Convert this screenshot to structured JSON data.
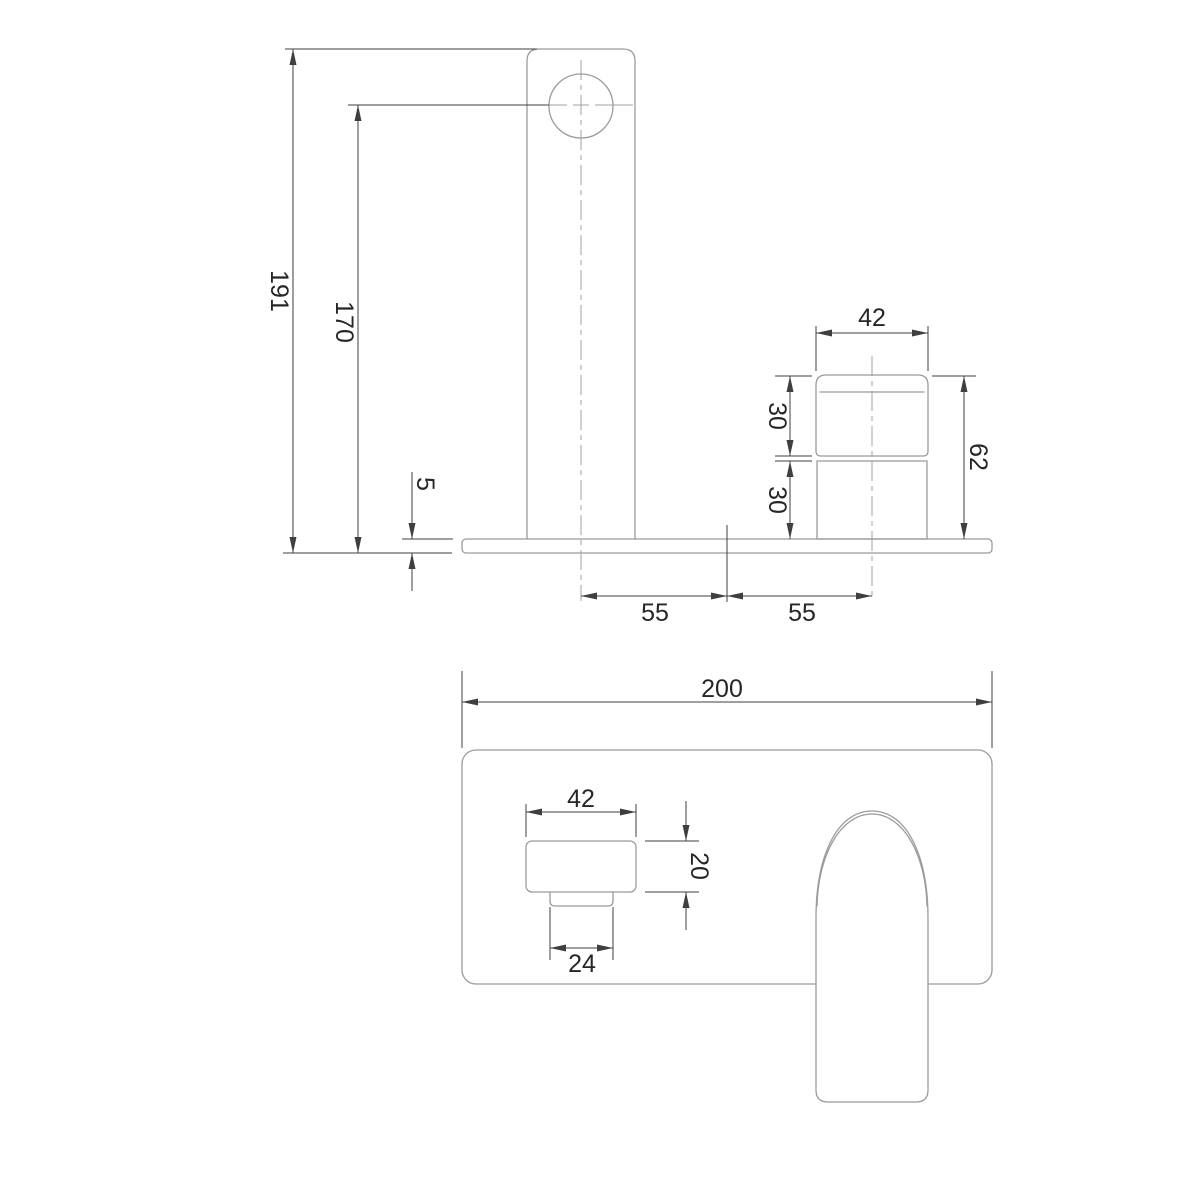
{
  "drawing": {
    "kind": "faucet-installation-dimension-drawing",
    "colors": {
      "background": "#ffffff",
      "geometry_line": "#9b9b9b",
      "centerline": "#a0a0a0",
      "dimension_line": "#3f3f3f",
      "dimension_text": "#262626"
    },
    "views": {
      "front": {
        "dims": {
          "overall_height": {
            "label": "191"
          },
          "outlet_height": {
            "label": "170"
          },
          "plate_thickness": {
            "label": "5"
          },
          "handle_width": {
            "label": "42"
          },
          "handle_cap_height": {
            "label": "30"
          },
          "handle_body_height": {
            "label": "30"
          },
          "handle_total_height": {
            "label": "62"
          },
          "spout_to_center": {
            "label": "55"
          },
          "center_to_handle": {
            "label": "55"
          }
        }
      },
      "plan": {
        "dims": {
          "plate_length": {
            "label": "200"
          },
          "spout_body_width": {
            "label": "42"
          },
          "spout_body_depth": {
            "label": "20"
          },
          "spout_tip_width": {
            "label": "24"
          }
        }
      }
    }
  }
}
